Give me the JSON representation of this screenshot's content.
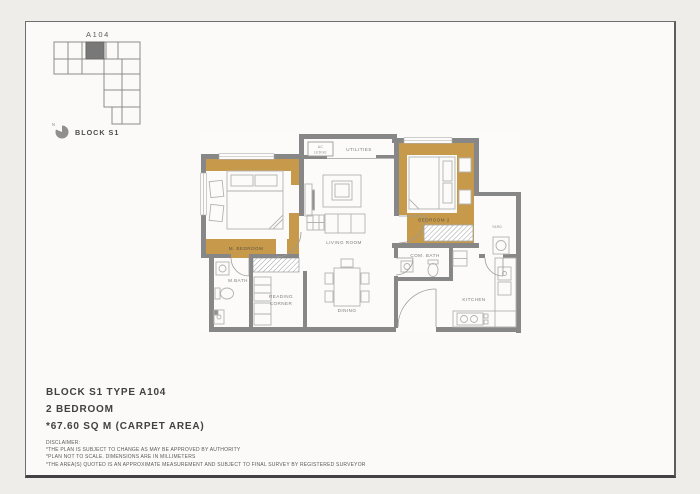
{
  "key_plan": {
    "unit_label": "A104",
    "north_label": "N",
    "block_label": "BLOCK S1"
  },
  "floor_plan": {
    "rooms": {
      "master_bedroom": "M. BEDROOM",
      "master_bath": "M.BATH",
      "reading_corner_line1": "READING",
      "reading_corner_line2": "CORNER",
      "living_room": "LIVING ROOM",
      "dining": "DINING",
      "ac_ledge_line1": "AC",
      "ac_ledge_line2": "LEDGE",
      "utilities": "UTILITIES",
      "bedroom_2": "BEDROOM 2",
      "yard": "YARD",
      "com_bath": "COM. BATH",
      "kitchen": "KITCHEN"
    },
    "colors": {
      "accent_wall": "#c79a4b",
      "wall": "#878787",
      "furniture": "#b2b2b2",
      "hatch": "#9f9f9f"
    }
  },
  "details": {
    "title_line1": "BLOCK S1 TYPE A104",
    "title_line2": "2 BEDROOM",
    "title_line3": "*67.60 SQ M (CARPET AREA)",
    "disclaimer_heading": "DISCLAIMER:",
    "disclaimer_line1": "*THE PLAN IS SUBJECT TO CHANGE AS MAY BE APPROVED BY AUTHORITY",
    "disclaimer_line2": "*PLAN NOT TO SCALE. DIMENSIONS ARE IN MILLIMETERS",
    "disclaimer_line3": "*THE AREA(S) QUOTED IS AN APPROXIMATE MEASUREMENT AND SUBJECT TO FINAL SURVEY BY REGISTERED SURVEYOR"
  }
}
